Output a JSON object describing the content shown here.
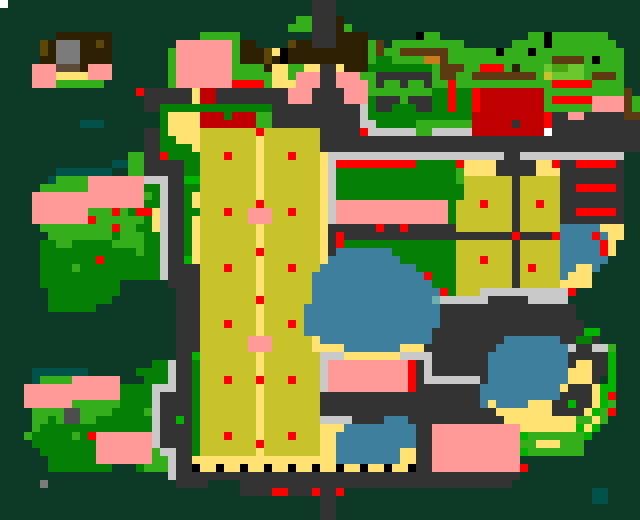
{
  "map": {
    "cell_size": 8,
    "grid_width": 80,
    "grid_height": 65,
    "palette": {
      ".": "#0d3a26",
      "f": "#057f05",
      "g": "#35ae1b",
      "G": "#00b400",
      "L": "#6cc72e",
      "M": "#4aa313",
      "y": "#ffe271",
      "F": "#c8c32b",
      "o": "#5c4708",
      "p": "#ff9a98",
      "r": "#fe0000",
      "R": "#c00000",
      "b": "#2e2103",
      "m": "#5d3a12",
      "O": "#c87c20",
      "d": "#5d4a39",
      "t": "#00524a",
      "T": "#6fb0ac",
      "B": "#3e7f9e",
      "a": "#333333",
      "c": "#c9c9c9",
      "e": "#7b7b7b",
      "E": "#4d4d4d",
      "k": "#000000",
      "w": "#ffffff"
    },
    "legend": {
      ".": "deep-forest-backdrop",
      "f": "tree-canopy",
      "g": "grass",
      "G": "vivid-bush",
      "L": "light-lawn",
      "M": "mid-lawn",
      "y": "sand-path",
      "F": "crop-field",
      "o": "olive-roof-detail",
      "p": "pink-blossom",
      "r": "red-marker",
      "R": "dark-red-roof",
      "b": "dark-brown-roof",
      "m": "soil-path",
      "O": "orange-crate",
      "d": "brown-awning",
      "t": "dark-teal-water",
      "T": "shallow-water",
      "B": "lake-water",
      "a": "asphalt-road",
      "c": "concrete-path",
      "e": "gray-rooftop",
      "E": "slate-block",
      "k": "black-post",
      "w": "white-speck"
    },
    "rows": [
      [
        "w...................",
        "...................a",
        "aa..................",
        "...................."
      ],
      [
        "....................",
        "...................a",
        "aa..................",
        "...................."
      ],
      [
        "....................",
        ".................gga",
        "aab.................",
        "...................."
      ],
      [
        "....................",
        "................ggga",
        "aabg................",
        "...................."
      ],
      [
        ".......bbbbbbb......",
        ".....ggggg.........a",
        "aabbbb......kgg.....",
        "......ggkggggggg...."
      ],
      [
        ".....obeeebbob......",
        "..pppppppgbb....obba",
        "aabbbbgm.ggggggggg..",
        "....ggggkgggggggg..."
      ],
      [
        ".....obeeebbbb......",
        ".gpppppppgbbboykbbbb",
        "bbbbbbgmggmmmmmmgggg",
        "ggkgggkggggggggggg.."
      ],
      [
        ".....bbeeebbbb......",
        ".gpppppppgbbbobkbbbb",
        "bbbbbbgffggggOOmgggg",
        "gggggggggmmmmgkggg.."
      ],
      [
        "....pppdddbppp......",
        ".gpppppppggggbyyggyy",
        "aaybbbffffffffgmmmgg",
        "rrrgbgggLMMLLggggg.."
      ],
      [
        "....pppyyyyppp......",
        ".gpppppppgggggyygppp",
        "aapppggaaaaaaagmmggm",
        "mmmmmmmgFLLLLgmmmg.."
      ],
      [
        "....pppgggggg.......",
        ".gppppppprrrrgyyyppp",
        "aappppgaggaggaggrggg",
        "gggggggggrrrrrgggg.."
      ],
      [
        ".................raa",
        "aaaayRRaaaaaaaaapppa",
        "aaapppggggggggffrffr",
        "RRRRRRRRggggggggggm."
      ],
      [
        "..................aa",
        "aaaayRRaaaaaaaaapppa",
        "aaapppfaaagaaaffrffr",
        "RRRRRRRRgrrrrrppppmg"
      ],
      [
        "..................aa",
        "ffffffffffffffaaaaaa",
        "aaaaacfaafffaaffrffr",
        "RRRRRRRRggggggppppmg"
      ],
      [
        "....................",
        "fyyyyRRRfRRRggaaaaaa",
        "aaaaacfffffffffffffR",
        "RRRRRRRRraappaaaaamm"
      ],
      [
        "..........ttt.......",
        "fyyyyRRRRRRRggaaaaaa",
        "aaaaaccfffffgggggggR",
        "RRRRaRRRraaaaaaaaaaa"
      ],
      [
        "..................aa",
        "fyyyyFFFFFFFrFFFFFFF",
        "aaaaarccccccggcccccR",
        "RRRRRRRRwaaaaaaaaaaa"
      ],
      [
        "..................aa",
        "ffyyyFFFFFFFyFFFFFFF",
        "aaaaaaaaaaaaaaaaaaaa",
        "aaaaaaaaaaaaaaaaaaaa"
      ],
      [
        "..................aa",
        "ffffyFFFFFFFyFFFFFFF",
        "aaaaaaaaaaaaaaaaaaaa",
        "aaaaaaaaaaaaaaaaaaaa"
      ],
      [
        "................ggaa",
        "rffffFFFrFFFyFFFrFFF",
        "yccccccccccccccccccc",
        "cccaaccccccccccccc.."
      ],
      [
        "..............ttggaa",
        "aaaffFFFFFFFyFFFFFFF",
        "ycrrrrrrrrrrfffffryy",
        "yyaaaaayyraarrrrra.."
      ],
      [
        ".......ttttttt..ggaa",
        "aaaffFFFFFFFyFFFFFFF",
        "ycfffffffffffffffgyy",
        "yyaaaaayyyaaaaaaaa.."
      ],
      [
        "......tggggpppppppcc",
        "caaGGFFFFFFFyFFFFFFF",
        "ycfffffffffffffffgFF",
        "FFFFaFFFFFaaaaaaaa.."
      ],
      [
        ".....ggggggpppppppff",
        "caaffFFFFFFFyFFFFFFF",
        "ycffffffffffffffffFF",
        "FFFFaFFFFFaarrrrra.."
      ],
      [
        "....ppppppppppppppgf",
        "caafyFFFFFFFyFFFFFFF",
        "ycffffffffffffffffFF",
        "FFFFaFFFFFaaaaaaaa.."
      ],
      [
        "....ppppppppppppppff",
        "caafyFFFFFFFrFFFFFFF",
        "ycppppppppppppppfFFF",
        "rFFFaFFrFFaaaaaaaa.."
      ],
      [
        "....pppppppgggrgfrry",
        "caaffFFFrFFpppFFrFFF",
        "ycppppppppppppppfFFF",
        "FFFFaFFFFFaarrrrra.."
      ],
      [
        "....ppppppprggggggfy",
        "caafyFFFFFFpppFFFFFF",
        "ycppppppppppppppfFFF",
        "FFFFaFFFFFaaaaaaaa.."
      ],
      [
        ".....gggggggggrggffy",
        "caafyFFFFFFFyFFFFFFF",
        "yaaaaaaraaraaaaaaFFF",
        "FFFFaFFFFFBBBBByyy.."
      ],
      [
        "......ggggggggfgggff",
        "caafyFFFFFFFyFFFFFFF",
        "yaraaaaaaaaaaaaaaaaa",
        "aaaaraaaarBBBBrByy.."
      ],
      [
        ".....ffggfffffggggff",
        "caafyFFFFFFFyFFFFFFF",
        "yarffffffffffffffFFF",
        "FFFFaFFFFFBBBBBry..."
      ],
      [
        ".....ffffffffffffgff",
        "caafyFFFFFFFrFFFFFFF",
        "yaBBBBBBBffffffffFFF",
        "FFFFaFFFFFBBBBBry..."
      ],
      [
        ".....fffffffrfffffff",
        "caaGyFFFFFFFyFFFFFFF",
        "yBBBBBBBBBfffffffFFF",
        "rFFFaFFFFFBBBBBB...."
      ],
      [
        ".....ffffgffffffffff",
        "caaaaFFFrFFFyFFFrFFF",
        "BBBBBBBBBBBBfffffFFF",
        "FFFFaFrFFFBByyB....."
      ],
      [
        ".....fffffffffffffff",
        "caaaaFFFFFFFyFFFFFFB",
        "BBBBBBBBBBBBBrfffFFF",
        "FFFFaFFFFFByyy......"
      ],
      [
        ".....ffffffffff.....",
        ".aaaaFFFFFFFyFFFFFFB",
        "BBBBBBBBBBBBBBfffFFF",
        "FFFFaFFFFFyyyy......"
      ],
      [
        "......fffffffff.....",
        "..aaaFFFFFFFyFFFFFFB",
        "BBBBBBBBBBBBBBBrfFFF",
        "cccccccccccr........"
      ],
      [
        "......ffffffff......",
        "..aaaFFFFFFFrFFFFFFB",
        "BBBBBBBBBBBBBBTccccc",
        "caaaaaccccc........."
      ],
      [
        "......ffffff........",
        "..aaaFFFFFFFyFFFFFBB",
        "BBBBBBBBBBBBBBBaaaaa",
        "aaaaaaaaaaaa........"
      ],
      [
        "....................",
        "..aaaFFFFFFFyFFFFFBB",
        "BBBBBBBBBBBBBBBaaaaa",
        "aaaaaaaaaaaa........"
      ],
      [
        "....................",
        "..aaaFFFrFFFyFFFrFBB",
        "BBBBBBBBBBBBBBBaaaaa",
        "aaaaaaaaaaaaa......."
      ],
      [
        "....................",
        "..aaaFFFFFFFyFFFFFBB",
        "BBBBBBBBBBBBBBaaaaaa",
        "aaaaaaaaaaaaaGG....."
      ],
      [
        "....................",
        "..aaaFFFFFFpppFFFFFy",
        "BBBBBBBBBBBBBBaaaaaa",
        "aaaBBBBBBBaaffa....."
      ],
      [
        "....................",
        "..aaaFFFFFFpppFFFFFy",
        "yyyBBBBBBByyyaaaaaaa",
        "aaBBBBBBBBBcaaccg..."
      ],
      [
        "....................",
        "..aaGFFFFFFFyFFFFFFF",
        "cccyyyyyyyccccaaaaaa",
        "aBBBBBBBBBBaaaaaG..."
      ],
      [
        "...................f",
        "fcaafFFFFFFFyFFFFFFF",
        "cppppppppppracaaaaaa",
        "aBBBBBBBBBBayyaaG..."
      ],
      [
        "....ttttttt......fff",
        "fcaafFFFFFFFyFFFFFFF",
        "cppppppppppracaaaaaa",
        "aBBBBBBBBBByyyaaG..."
      ],
      [
        "....tggggpppppp...ff",
        "fcaafFFFrFFFrFFFrFFF",
        "cppppppppppraccccccc",
        "aBBBBBBBBBByyya.G..."
      ],
      [
        "...ppppppppppppffffc",
        "ccaafFFFFFFFyFFFFFFF",
        "cppppppppppraaaaaaaa",
        "BBBBBBBBBByaaayGG..."
      ],
      [
        "...ppppppppppppffffc",
        "aaaafFFFFFFFyFFFFFFF",
        "aaaaaaaaaaaaaaaaaaaa",
        "BBBBBBBBBBaaaayGr..."
      ],
      [
        "...ppppppggggggffffc",
        "aaaafFFFFFFFyFFFFFFF",
        "aaaaaaaaaaaaaaaaaaaa",
        "ByBBBByyyaaGaayGg..."
      ],
      [
        "....ggggEEggggffffgc",
        "aaaafFFFFFFFyFFFFFFF",
        "aaaaaaaaaaaaaaaaaaaa",
        "aayyyyyyyaaaayGgr..."
      ],
      [
        "....ggfgEEggfffffffc",
        "aaGafFFFFFFFyFFFFFFF",
        "ccccaaaaBBBaaaaaaaaa",
        "aaayyyyyyyyyggyg...."
      ],
      [
        "....gffffffffffffffc",
        "aaaafFFFFFFFyFFFFFFF",
        "yyyBBBBBBBBBaapppppp",
        "pppppyyyyyyyGyG....."
      ],
      [
        "...gfffffgfrpppppppc",
        "aaaafFFFrFFFyFFFrFFF",
        "yyBBBBBBBBBBaapppppp",
        "pppppGgggggggG......"
      ],
      [
        "....ffffffffpppppppc",
        "aaaafFFFFFFFrFFFFFFF",
        "yyBBBBBBBBBBaapppppp",
        "pppppggyyyggg......."
      ],
      [
        ".....fffffffpppppppg",
        "ccaafFFFFFFFyFFFFFFF",
        "yyBBBBBBBByyaapppppp",
        "pppppGggggggg......."
      ],
      [
        "......ffffffpppppppg",
        "gcaayyyyyyyyyyyyyyyy",
        "yyBBBBBBBByyaapppppp",
        "ppppp..............."
      ],
      [
        "......ffffffff...fgg",
        "gcaakyykyykyykyykyyk",
        "yykyykyykyykaapppppp",
        "pppppr.............."
      ],
      [
        "....................",
        ".caaaaaaaaaaaaaaaaaa",
        "aaaaaaaaaaaaaaaaaaaa",
        "aaaaa..............."
      ],
      [
        ".....e..............",
        "..aaaa....aaaaaaaaaa",
        "aaaaaaaaaaaaaaaaaaaa",
        "aaaa................"
      ],
      [
        "....................",
        "..........aaaarraaar",
        "aar.................",
        "..............tt...."
      ],
      [
        "....................",
        "....................",
        "aa..................",
        "..............tt...."
      ],
      [
        "....................",
        "....................",
        "aa..................",
        "...................."
      ],
      [
        "....................",
        "....................",
        "aa..................",
        "...................."
      ]
    ]
  }
}
